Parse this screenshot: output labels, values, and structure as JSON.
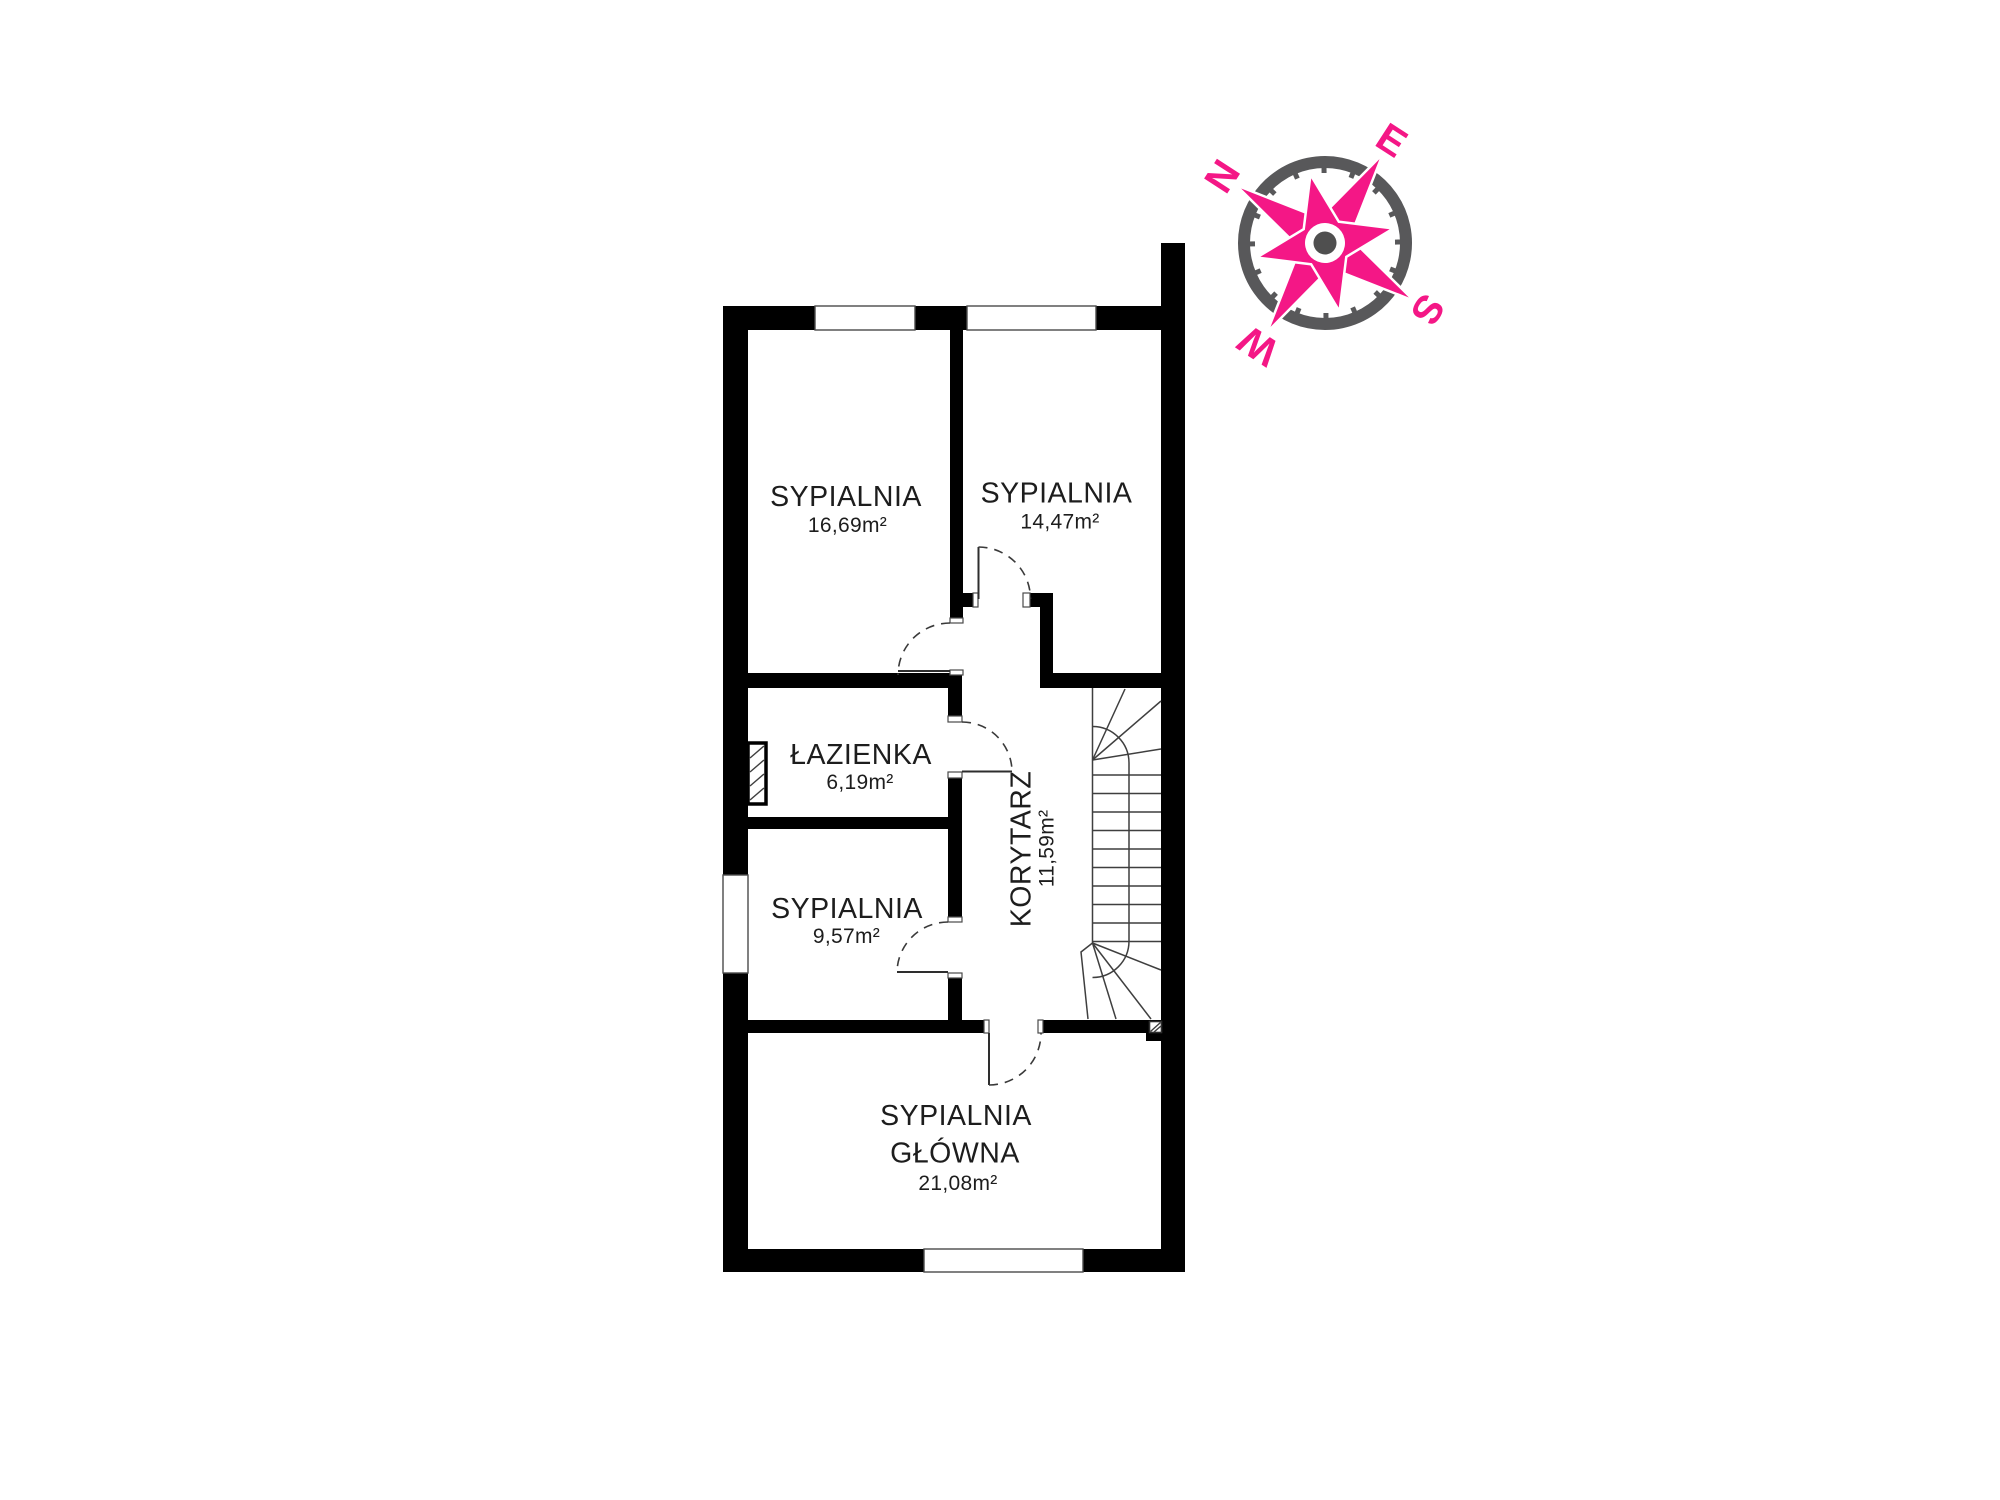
{
  "floor_plan": {
    "rooms": [
      {
        "name": "SYPIALNIA",
        "area": "16,69m²"
      },
      {
        "name": "SYPIALNIA",
        "area": "14,47m²"
      },
      {
        "name": "ŁAZIENKA",
        "area": "6,19m²"
      },
      {
        "name": "SYPIALNIA",
        "area": "9,57m²"
      },
      {
        "name": "KORYTARZ",
        "area": "11,59m²"
      },
      {
        "name": "SYPIALNIA",
        "name_line2": "GŁÓWNA",
        "area": "21,08m²"
      }
    ]
  },
  "compass": {
    "north": "N",
    "east": "E",
    "south": "S",
    "west": "W"
  },
  "colors": {
    "wall": "#000000",
    "detail_line": "#3a3a3a",
    "accent_pink": "#F41786",
    "compass_gray": "#58585A",
    "text": "#1d1d1d",
    "background": "#ffffff"
  }
}
